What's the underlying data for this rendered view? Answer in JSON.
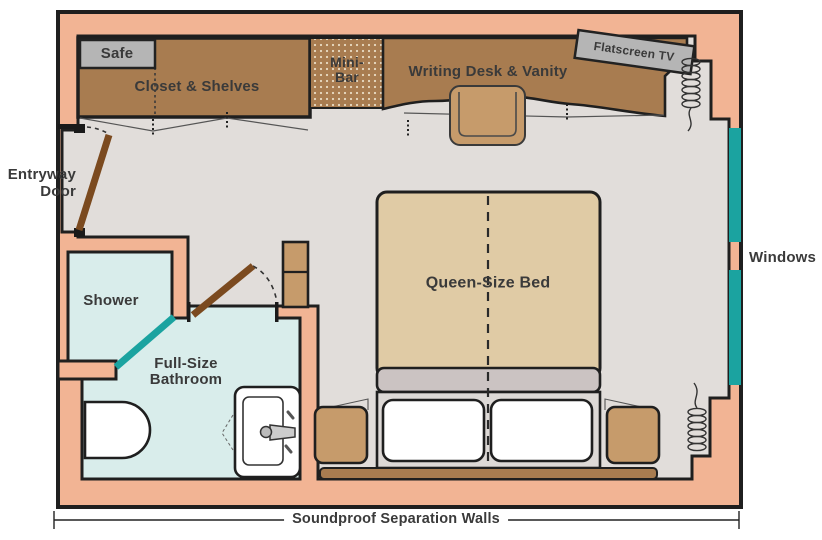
{
  "diagram_type": "floor-plan",
  "labels": {
    "safe": "Safe",
    "closet": "Closet & Shelves",
    "minibar_line1": "Mini-",
    "minibar_line2": "Bar",
    "desk": "Writing Desk & Vanity",
    "tv": "Flatscreen TV",
    "entry_line1": "Entryway",
    "entry_line2": "Door",
    "shower": "Shower",
    "bath_line1": "Full-Size",
    "bath_line2": "Bathroom",
    "bed": "Queen-Size Bed",
    "windows": "Windows",
    "soundproof": "Soundproof Separation Walls"
  },
  "colors": {
    "wall": "#F2B494",
    "floor": "#E1DDDA",
    "wood": "#A87C50",
    "wood_light": "#C69B6B",
    "bed": "#E0CBA5",
    "bed_foot": "#CBC3C2",
    "frame": "#DDD9D6",
    "bath": "#D9EDEB",
    "teal": "#1BA3A0",
    "fixture_gray": "#B5B5B5",
    "door": "#7B4A1F",
    "outline": "#1F1F1F",
    "text": "#3A3A3A"
  }
}
